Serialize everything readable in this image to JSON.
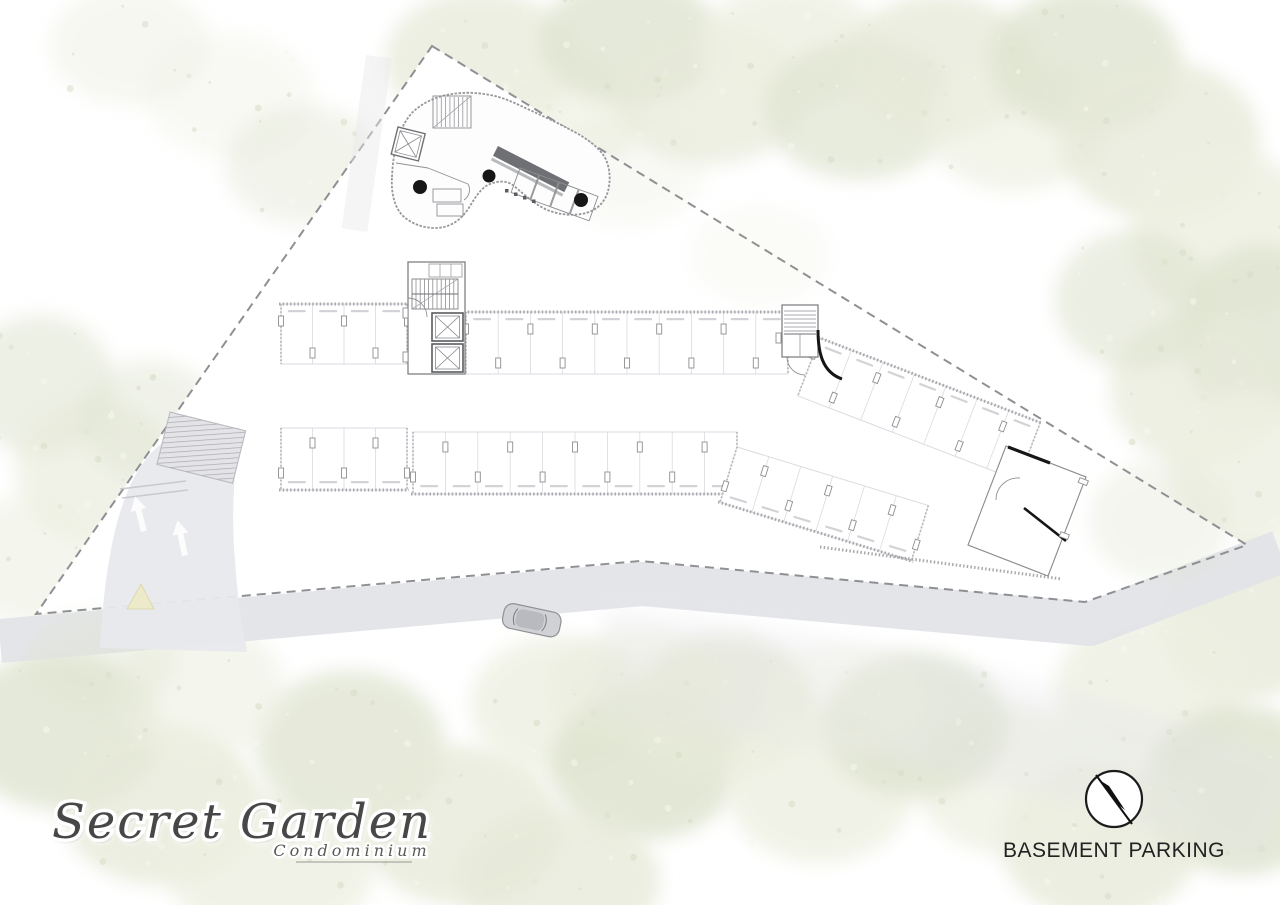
{
  "branding": {
    "name_script": "Secret Garden",
    "subtitle_script": "Condominium"
  },
  "legend": {
    "label": "BASEMENT PARKING",
    "north_icon": "north-arrow-icon"
  },
  "palette": {
    "paper": "#ffffff",
    "foliage_light": "#eef0e2",
    "foliage_mid": "#e7ead9",
    "foliage_deep": "#dfe4d0",
    "road": "#e2e3e7",
    "driveway": "#e8e9ed",
    "island": "#eceac9",
    "plan_line": "#96979a",
    "stall_line": "#dadbe0",
    "wall_hatch": "#a8a9ac",
    "ink_black": "#161616"
  },
  "parking": {
    "rows": [
      {
        "id": "upper-left",
        "stalls": 4
      },
      {
        "id": "upper-right",
        "stalls": 10
      },
      {
        "id": "lower-left",
        "stalls": 4
      },
      {
        "id": "lower-right",
        "stalls": 10
      },
      {
        "id": "east-wing-upper",
        "stalls": 7
      },
      {
        "id": "east-wing-lower",
        "stalls": 6
      }
    ]
  }
}
